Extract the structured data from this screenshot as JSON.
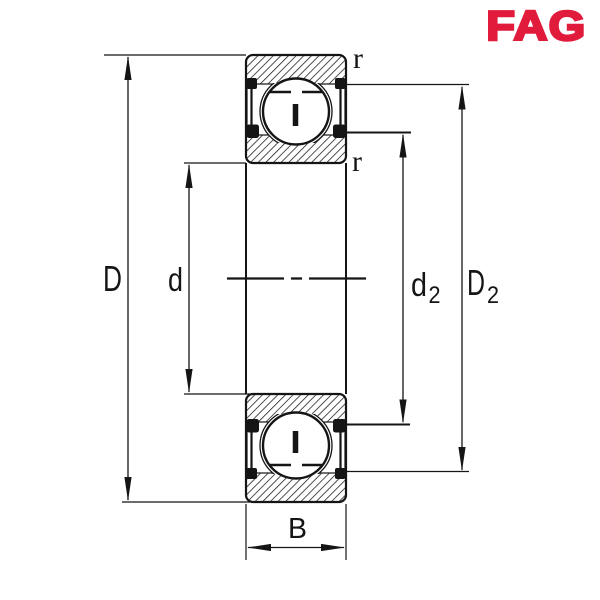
{
  "brand": {
    "logo_text": "FAG",
    "logo_color": "#E11B3C"
  },
  "drawing": {
    "colors": {
      "line": "#151515",
      "background": "#ffffff"
    },
    "labels": {
      "outer_diameter": "D",
      "bore_diameter": "d",
      "inner_shoulder_base": "d",
      "inner_shoulder_sub": "2",
      "outer_shoulder_base": "D",
      "outer_shoulder_sub": "2",
      "width": "B",
      "chamfer_radius_top": "r",
      "chamfer_radius_bottom": "r"
    }
  }
}
